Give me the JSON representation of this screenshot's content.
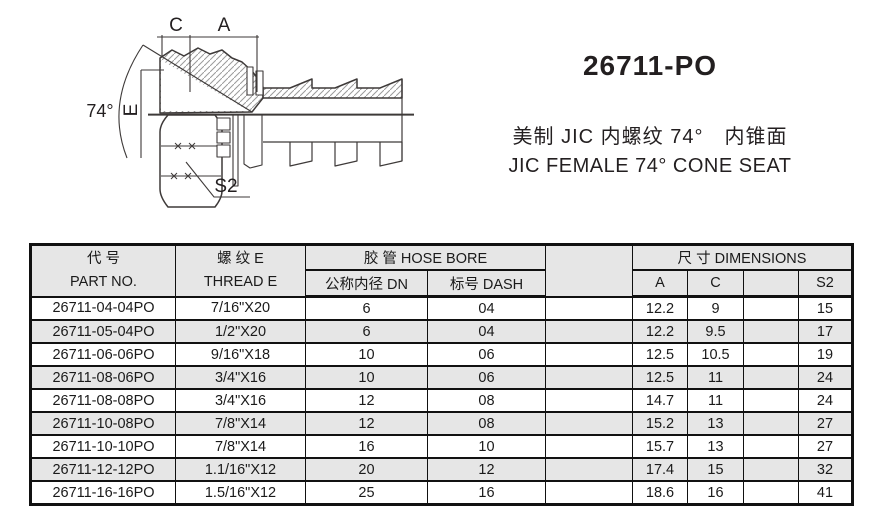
{
  "title_block": {
    "model": "26711-PO",
    "subtitle_zh": "美制 JIC 内螺纹 74°　内锥面",
    "subtitle_en": "JIC FEMALE 74°  CONE SEAT"
  },
  "drawing": {
    "labels": {
      "dim_c": "C",
      "dim_a": "A",
      "dim_e": "E",
      "angle": "74°",
      "wrench": "S2"
    }
  },
  "table": {
    "header": {
      "part_no_zh": "代  号",
      "part_no_en": "PART NO.",
      "thread_zh": "螺  纹 E",
      "thread_en": "THREAD  E",
      "hose_bore": "胶  管 HOSE BORE",
      "dn": "公称内径 DN",
      "dash": "标号 DASH",
      "spacer": "",
      "dimensions": "尺 寸  DIMENSIONS",
      "col_a": "A",
      "col_c": "C",
      "col_blank": "",
      "col_s2": "S2"
    },
    "rows": [
      [
        "26711-04-04PO",
        "7/16\"X20",
        "6",
        "04",
        "",
        "12.2",
        "9",
        "",
        "15"
      ],
      [
        "26711-05-04PO",
        "1/2\"X20",
        "6",
        "04",
        "",
        "12.2",
        "9.5",
        "",
        "17"
      ],
      [
        "26711-06-06PO",
        "9/16\"X18",
        "10",
        "06",
        "",
        "12.5",
        "10.5",
        "",
        "19"
      ],
      [
        "26711-08-06PO",
        "3/4\"X16",
        "10",
        "06",
        "",
        "12.5",
        "11",
        "",
        "24"
      ],
      [
        "26711-08-08PO",
        "3/4\"X16",
        "12",
        "08",
        "",
        "14.7",
        "11",
        "",
        "24"
      ],
      [
        "26711-10-08PO",
        "7/8\"X14",
        "12",
        "08",
        "",
        "15.2",
        "13",
        "",
        "27"
      ],
      [
        "26711-10-10PO",
        "7/8\"X14",
        "16",
        "10",
        "",
        "15.7",
        "13",
        "",
        "27"
      ],
      [
        "26711-12-12PO",
        "1.1/16\"X12",
        "20",
        "12",
        "",
        "17.4",
        "15",
        "",
        "32"
      ],
      [
        "26711-16-16PO",
        "1.5/16\"X12",
        "25",
        "16",
        "",
        "18.6",
        "16",
        "",
        "41"
      ]
    ],
    "colors": {
      "header_bg": "#e6e6e6",
      "row_alt_bg": "#e6e6e6",
      "border": "#111111"
    }
  }
}
